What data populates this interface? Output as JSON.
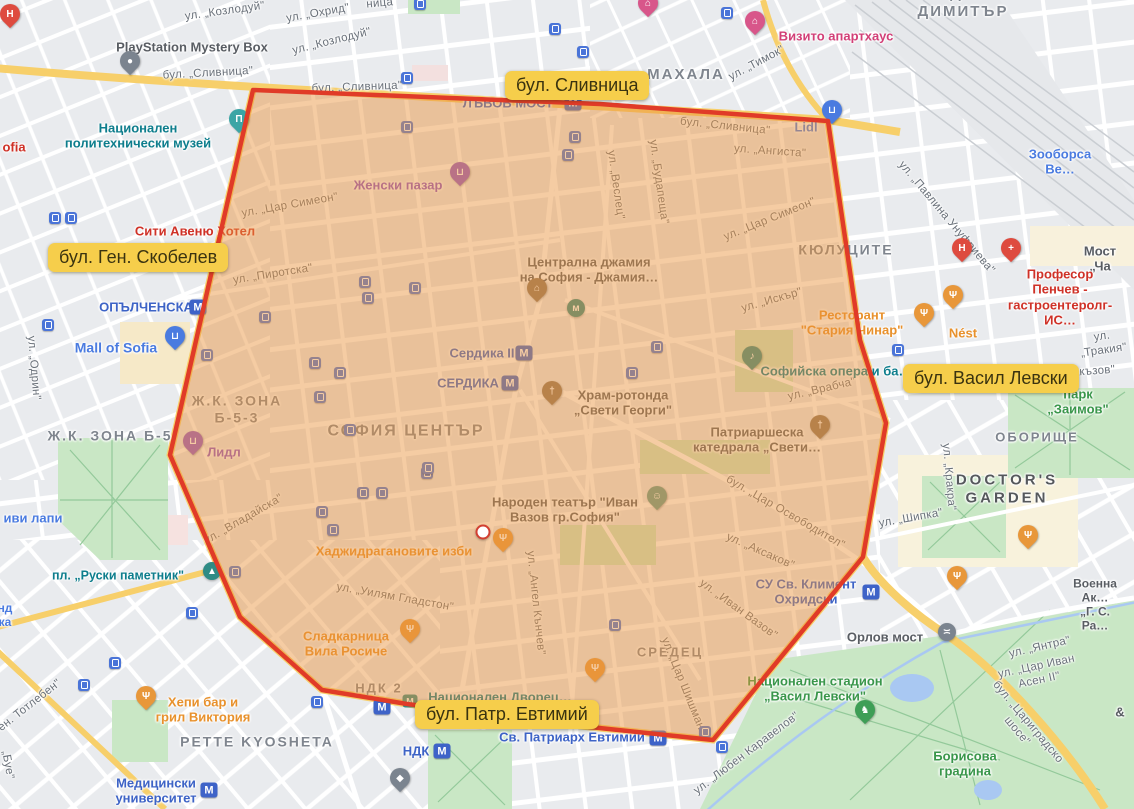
{
  "canvas": {
    "width": 1134,
    "height": 809
  },
  "palette": {
    "map_background": "#e9ebee",
    "road_white": "#ffffff",
    "road_yellow": "#f7cf6a",
    "park_green": "#c9e7c5",
    "water_blue": "#a9c8f2",
    "railway": "#e6e8eb",
    "overlay_fill": "#e9923c",
    "overlay_stroke": "#e03b28",
    "highlight_label_bg": "#f6ce4b",
    "highlight_label_text": "#3a3310",
    "metro_blue": "#3d63c6",
    "transit_blue": "#4a74d8",
    "poi_teal": "#0d7d8c",
    "poi_orange": "#e8912c",
    "poi_red": "#cf3127",
    "poi_green": "#39964a",
    "poi_purple": "#8b53c6",
    "poi_blue": "#4a7be0"
  },
  "region_overlay": {
    "points": "253,90 600,104 828,121 860,340 886,423 863,557 713,740 590,727 407,704 322,690 240,617 170,455",
    "fill": "#e9923c",
    "fill_opacity": 0.47,
    "stroke": "#e03b28",
    "stroke_width": 4.5
  },
  "center_marker": {
    "x": 483,
    "y": 532
  },
  "highlight_labels": [
    {
      "text": "бул. Сливница",
      "left": 505,
      "top": 71
    },
    {
      "text": "бул. Ген. Скобелев",
      "left": 48,
      "top": 243
    },
    {
      "text": "бул. Васил Левски",
      "left": 903,
      "top": 364
    },
    {
      "text": "бул. Патр. Евтимий",
      "left": 415,
      "top": 700
    }
  ],
  "labels": [
    {
      "t": "ХАДЖИ",
      "x": 958,
      "y": -6,
      "c": "area",
      "s": 15
    },
    {
      "t": "ДИМИТЪР",
      "x": 963,
      "y": 12,
      "c": "area",
      "s": 15
    },
    {
      "t": "МАХАЛА",
      "x": 686,
      "y": 75,
      "c": "area",
      "s": 15
    },
    {
      "t": "КЮЛУЦИТЕ",
      "x": 846,
      "y": 250,
      "c": "area",
      "s": 14
    },
    {
      "t": "Ж.К. ЗОНА\nБ-5-3",
      "x": 237,
      "y": 409,
      "c": "area",
      "s": 14
    },
    {
      "t": "Ж.К. ЗОНА Б-5",
      "x": 110,
      "y": 436,
      "c": "area",
      "s": 14
    },
    {
      "t": "СОФИЯ ЦЕНТЪР",
      "x": 406,
      "y": 432,
      "c": "area",
      "s": 16
    },
    {
      "t": "СРЕДЕЦ",
      "x": 670,
      "y": 652,
      "c": "area",
      "s": 13
    },
    {
      "t": "ОБОРИЩЕ",
      "x": 1037,
      "y": 437,
      "c": "area",
      "s": 13
    },
    {
      "t": "PETTE KYOSHETA",
      "x": 257,
      "y": 742,
      "c": "area",
      "s": 14
    },
    {
      "t": "DOCTOR'S\nGARDEN",
      "x": 1007,
      "y": 489,
      "c": "area-dark",
      "s": 15
    },
    {
      "t": "НДК 2",
      "x": 379,
      "y": 688,
      "c": "area",
      "s": 13
    },
    {
      "t": "ул. „Козлодуй\"",
      "x": 225,
      "y": 12,
      "c": "street",
      "r": -8
    },
    {
      "t": "ул. „Охрид\"",
      "x": 318,
      "y": 14,
      "c": "street",
      "r": -10
    },
    {
      "t": "ул. „Козлодуй\"",
      "x": 332,
      "y": 42,
      "c": "street",
      "r": -14
    },
    {
      "t": "ница\"",
      "x": 382,
      "y": 4,
      "c": "street",
      "r": -5
    },
    {
      "t": "бул. „Сливница\"",
      "x": 208,
      "y": 74,
      "c": "street",
      "r": -3
    },
    {
      "t": "бул. „Сливница\"",
      "x": 357,
      "y": 88,
      "c": "street",
      "r": -2
    },
    {
      "t": "бул. „Сливница\"",
      "x": 725,
      "y": 127,
      "c": "street",
      "r": 6
    },
    {
      "t": "ул. „Ангиста\"",
      "x": 770,
      "y": 152,
      "c": "street",
      "r": 4
    },
    {
      "t": "ул. „Тимок\"",
      "x": 757,
      "y": 64,
      "c": "street",
      "r": -28
    },
    {
      "t": "ул. „Павлина Унуфриева\"",
      "x": 946,
      "y": 218,
      "c": "street",
      "r": 50
    },
    {
      "t": "ул. „Веслец\"",
      "x": 615,
      "y": 185,
      "c": "street",
      "r": 82
    },
    {
      "t": "ул. „Будапеща\"",
      "x": 658,
      "y": 182,
      "c": "street",
      "r": 82
    },
    {
      "t": "ул. „Цар Симеон\"",
      "x": 290,
      "y": 206,
      "c": "street",
      "r": -10
    },
    {
      "t": "ул. „Цар Симеон\"",
      "x": 770,
      "y": 220,
      "c": "street",
      "r": -22
    },
    {
      "t": "ул. „Пиротска\"",
      "x": 273,
      "y": 275,
      "c": "street",
      "r": -9
    },
    {
      "t": "ул. „Искър\"",
      "x": 772,
      "y": 301,
      "c": "street",
      "r": -16
    },
    {
      "t": "ул. „Одрин\"",
      "x": 33,
      "y": 368,
      "c": "street",
      "r": 85
    },
    {
      "t": "ул. „Врабча\"",
      "x": 822,
      "y": 390,
      "c": "street",
      "r": -13
    },
    {
      "t": "ул. „Тракия\"",
      "x": 1103,
      "y": 344,
      "c": "street",
      "r": -8
    },
    {
      "t": "акъзов\"",
      "x": 1094,
      "y": 372,
      "c": "street",
      "r": -4
    },
    {
      "t": "ул. „Кракра\"",
      "x": 948,
      "y": 477,
      "c": "street",
      "r": 85
    },
    {
      "t": "ул. „Шипка\"",
      "x": 911,
      "y": 519,
      "c": "street",
      "r": -10
    },
    {
      "t": "бул. „Цар Освободител\"",
      "x": 785,
      "y": 513,
      "c": "street",
      "r": 30
    },
    {
      "t": "ул. „Аксаков\"",
      "x": 760,
      "y": 552,
      "c": "street",
      "r": 24
    },
    {
      "t": "ул. „Иван Вазов\"",
      "x": 738,
      "y": 610,
      "c": "street",
      "r": 36
    },
    {
      "t": "ул. „Владайска\"",
      "x": 244,
      "y": 520,
      "c": "street",
      "r": -30
    },
    {
      "t": "ул. „Уилям Гладстон\"",
      "x": 395,
      "y": 598,
      "c": "street",
      "r": 10
    },
    {
      "t": "ул. „Ангел Кънчев\"",
      "x": 535,
      "y": 603,
      "c": "street",
      "r": 84
    },
    {
      "t": "ул. „Цар Шишман\"",
      "x": 683,
      "y": 686,
      "c": "street",
      "r": 68
    },
    {
      "t": "ул. „Любен Каравелов\"",
      "x": 747,
      "y": 754,
      "c": "street",
      "r": -37
    },
    {
      "t": "ул. „Янтра\"",
      "x": 1040,
      "y": 648,
      "c": "street",
      "r": -13
    },
    {
      "t": "ул. „Цар Иван Асен II\"",
      "x": 1038,
      "y": 674,
      "c": "street",
      "r": -12
    },
    {
      "t": "бул. „Цариградско шосе\"",
      "x": 1022,
      "y": 727,
      "c": "street",
      "r": 50
    },
    {
      "t": "ен. Тотлебен\"",
      "x": 30,
      "y": 706,
      "c": "street",
      "r": -38
    },
    {
      "t": "„Буе\"",
      "x": 7,
      "y": 765,
      "c": "street",
      "r": 80
    },
    {
      "t": "Мост „Ча",
      "x": 1100,
      "y": 259,
      "c": "poi",
      "s": 13
    },
    {
      "t": "&",
      "x": 1120,
      "y": 712,
      "c": "poi",
      "s": 13
    },
    {
      "t": "PlayStation Mystery Box",
      "x": 192,
      "y": 47,
      "c": "poi",
      "s": 13
    },
    {
      "t": "Централна джамия\nна София - Джамия…",
      "x": 589,
      "y": 270,
      "c": "poi",
      "s": 13
    },
    {
      "t": "Храм-ротонда\n„Свети Георги\"",
      "x": 623,
      "y": 403,
      "c": "poi",
      "s": 13
    },
    {
      "t": "Патриаршеска\nкатедрала „Свети…",
      "x": 757,
      "y": 440,
      "c": "poi",
      "s": 13
    },
    {
      "t": "Народен театър \"Иван\nВазов гр.София\"",
      "x": 565,
      "y": 510,
      "c": "poi",
      "s": 13
    },
    {
      "t": "Орлов мост",
      "x": 885,
      "y": 637,
      "c": "poi",
      "s": 13
    },
    {
      "t": "Военна Ак…\n„Г. С. Ра…",
      "x": 1095,
      "y": 605,
      "c": "poi",
      "s": 12
    },
    {
      "t": "Национален\nполитехнически музей",
      "x": 138,
      "y": 136,
      "c": "teal",
      "s": 13
    },
    {
      "t": "пл. „Руски паметник\"",
      "x": 118,
      "y": 576,
      "c": "teal",
      "s": 12.5
    },
    {
      "t": "Софийска опера и ба…",
      "x": 836,
      "y": 371,
      "c": "teal",
      "s": 13
    },
    {
      "t": "Национален Дворец…",
      "x": 500,
      "y": 697,
      "c": "teal",
      "s": 13
    },
    {
      "t": "Mall of Sofia",
      "x": 116,
      "y": 348,
      "c": "blue",
      "s": 14
    },
    {
      "t": "иви лапи",
      "x": 33,
      "y": 518,
      "c": "blue",
      "s": 13
    },
    {
      "t": "Зооборса Ве…",
      "x": 1060,
      "y": 162,
      "c": "blue",
      "s": 13
    },
    {
      "t": "Lidl",
      "x": 806,
      "y": 127,
      "c": "blue",
      "s": 13
    },
    {
      "t": "нд",
      "x": 5,
      "y": 608,
      "c": "blue",
      "s": 12
    },
    {
      "t": "ка",
      "x": 5,
      "y": 622,
      "c": "blue",
      "s": 12
    },
    {
      "t": "Женски пазар",
      "x": 398,
      "y": 185,
      "c": "purple",
      "s": 13
    },
    {
      "t": "Лидл",
      "x": 224,
      "y": 452,
      "c": "purple",
      "s": 13
    },
    {
      "t": "Сити Авеню Хотел",
      "x": 195,
      "y": 231,
      "c": "red",
      "s": 13
    },
    {
      "t": "Професор Пенчев -\nгастроентеролг- ИС…",
      "x": 1060,
      "y": 297,
      "c": "red",
      "s": 13
    },
    {
      "t": "ofia",
      "x": 14,
      "y": 147,
      "c": "red",
      "s": 13
    },
    {
      "t": "Визито апартхаус",
      "x": 836,
      "y": 36,
      "c": "pink",
      "s": 13
    },
    {
      "t": "Ресторант\n\"Стария Чинар\"",
      "x": 852,
      "y": 323,
      "c": "orange",
      "s": 13
    },
    {
      "t": "Nést",
      "x": 963,
      "y": 333,
      "c": "orange",
      "s": 13
    },
    {
      "t": "Хаджидрагановите изби",
      "x": 394,
      "y": 551,
      "c": "orange",
      "s": 13
    },
    {
      "t": "Сладкарница\nВила Росиче",
      "x": 346,
      "y": 644,
      "c": "orange",
      "s": 13
    },
    {
      "t": "Хепи бар и\nгрил Виктория",
      "x": 203,
      "y": 710,
      "c": "orange",
      "s": 13
    },
    {
      "t": "парк „Заимов\"",
      "x": 1078,
      "y": 402,
      "c": "green",
      "s": 13
    },
    {
      "t": "Национален стадион\n„Васил Левски\"",
      "x": 815,
      "y": 689,
      "c": "green",
      "s": 13
    },
    {
      "t": "Борисова\nградина",
      "x": 965,
      "y": 764,
      "c": "green",
      "s": 13
    },
    {
      "t": "ОПЪЛЧЕНСКА",
      "x": 146,
      "y": 307,
      "c": "metro",
      "s": 13
    },
    {
      "t": "Сердика II",
      "x": 482,
      "y": 353,
      "c": "metro",
      "s": 13
    },
    {
      "t": "СЕРДИКА",
      "x": 468,
      "y": 383,
      "c": "metro",
      "s": 13
    },
    {
      "t": "ЛЪВОВ МОСТ",
      "x": 508,
      "y": 103,
      "c": "metro",
      "s": 13
    },
    {
      "t": "СУ Св. Климент\nОхридски",
      "x": 806,
      "y": 592,
      "c": "metro",
      "s": 13
    },
    {
      "t": "Св. Патриарх Евтимий",
      "x": 572,
      "y": 737,
      "c": "metro",
      "s": 13
    },
    {
      "t": "НДК",
      "x": 416,
      "y": 751,
      "c": "metro",
      "s": 13
    },
    {
      "t": "Медицински\nуниверситет",
      "x": 156,
      "y": 791,
      "c": "metro",
      "s": 13
    }
  ],
  "pins": [
    {
      "x": 10,
      "y": 25,
      "color": "#de4b3f",
      "glyph": "H",
      "shape": "pin",
      "name": "hospital-pin"
    },
    {
      "x": 130,
      "y": 72,
      "color": "#7b848f",
      "glyph": "●",
      "shape": "pin",
      "name": "playstation-pin"
    },
    {
      "x": 239,
      "y": 130,
      "color": "#3ba5a5",
      "glyph": "Π",
      "shape": "pin",
      "name": "museum-pin"
    },
    {
      "x": 460,
      "y": 183,
      "color": "#8f55c9",
      "glyph": "⊔",
      "shape": "pin",
      "name": "market-cart-pin"
    },
    {
      "x": 537,
      "y": 299,
      "color": "#8d7358",
      "glyph": "⌂",
      "shape": "pin",
      "name": "mosque-pin"
    },
    {
      "x": 576,
      "y": 308,
      "color": "#2f8b85",
      "glyph": "м",
      "shape": "dot",
      "name": "baths-dot"
    },
    {
      "x": 552,
      "y": 402,
      "color": "#8d7358",
      "glyph": "†",
      "shape": "pin",
      "name": "rotunda-church-pin"
    },
    {
      "x": 820,
      "y": 436,
      "color": "#8d7358",
      "glyph": "†",
      "shape": "pin",
      "name": "cathedral-pin"
    },
    {
      "x": 752,
      "y": 367,
      "color": "#2f8b85",
      "glyph": "♪",
      "shape": "pin",
      "name": "opera-pin"
    },
    {
      "x": 212,
      "y": 571,
      "color": "#2f8b85",
      "glyph": "▲",
      "shape": "dot",
      "name": "monument-dot"
    },
    {
      "x": 175,
      "y": 347,
      "color": "#4a7be0",
      "glyph": "⊔",
      "shape": "pin",
      "name": "mall-pin"
    },
    {
      "x": 193,
      "y": 452,
      "color": "#8f55c9",
      "glyph": "⊔",
      "shape": "pin",
      "name": "lidl-bg-pin"
    },
    {
      "x": 832,
      "y": 121,
      "color": "#4a7be0",
      "glyph": "⊔",
      "shape": "pin",
      "name": "lidl-pin"
    },
    {
      "x": 924,
      "y": 324,
      "color": "#e8973a",
      "glyph": "Ψ",
      "shape": "pin",
      "name": "restaurant-pin"
    },
    {
      "x": 953,
      "y": 306,
      "color": "#e8973a",
      "glyph": "Ψ",
      "shape": "pin",
      "name": "restaurant-pin"
    },
    {
      "x": 962,
      "y": 259,
      "color": "#de4b3f",
      "glyph": "H",
      "shape": "pin",
      "name": "hospital-pin"
    },
    {
      "x": 1011,
      "y": 259,
      "color": "#de4b3f",
      "glyph": "+",
      "shape": "pin",
      "name": "clinic-pin"
    },
    {
      "x": 648,
      "y": 14,
      "color": "#d8568a",
      "glyph": "⌂",
      "shape": "pin",
      "name": "hotel-pin"
    },
    {
      "x": 755,
      "y": 32,
      "color": "#d8568a",
      "glyph": "⌂",
      "shape": "pin",
      "name": "hotel-pin"
    },
    {
      "x": 503,
      "y": 549,
      "color": "#e8973a",
      "glyph": "Ψ",
      "shape": "pin",
      "name": "restaurant-pin"
    },
    {
      "x": 657,
      "y": 507,
      "color": "#5f9c8f",
      "glyph": "☺",
      "shape": "pin",
      "name": "theatre-pin"
    },
    {
      "x": 410,
      "y": 640,
      "color": "#e8973a",
      "glyph": "Ψ",
      "shape": "pin",
      "name": "restaurant-pin"
    },
    {
      "x": 146,
      "y": 707,
      "color": "#e8973a",
      "glyph": "Ψ",
      "shape": "pin",
      "name": "restaurant-pin"
    },
    {
      "x": 595,
      "y": 679,
      "color": "#e8973a",
      "glyph": "Ψ",
      "shape": "pin",
      "name": "restaurant-pin"
    },
    {
      "x": 1028,
      "y": 546,
      "color": "#e8973a",
      "glyph": "Ψ",
      "shape": "pin",
      "name": "restaurant-pin"
    },
    {
      "x": 957,
      "y": 587,
      "color": "#e8973a",
      "glyph": "Ψ",
      "shape": "pin",
      "name": "restaurant-pin"
    },
    {
      "x": 947,
      "y": 632,
      "color": "#7b848f",
      "glyph": "≍",
      "shape": "dot",
      "name": "bridge-dot"
    },
    {
      "x": 400,
      "y": 789,
      "color": "#7b848f",
      "glyph": "◆",
      "shape": "pin",
      "name": "university-pin"
    },
    {
      "x": 865,
      "y": 721,
      "color": "#3e9e56",
      "glyph": "♞",
      "shape": "pin",
      "name": "zoo-pin"
    },
    {
      "x": 410,
      "y": 701,
      "color": "#2f8b85",
      "glyph": "М",
      "shape": "sq",
      "name": "culture-palace-icon"
    }
  ],
  "metro_icons": [
    [
      198,
      307
    ],
    [
      524,
      353
    ],
    [
      510,
      383
    ],
    [
      573,
      103
    ],
    [
      871,
      592
    ],
    [
      658,
      738
    ],
    [
      442,
      751
    ],
    [
      382,
      707
    ],
    [
      209,
      790
    ]
  ],
  "transit_stops": [
    [
      420,
      4
    ],
    [
      555,
      29
    ],
    [
      583,
      52
    ],
    [
      407,
      78
    ],
    [
      727,
      13
    ],
    [
      55,
      218
    ],
    [
      71,
      218
    ],
    [
      48,
      325
    ],
    [
      898,
      350
    ],
    [
      115,
      663
    ],
    [
      84,
      685
    ],
    [
      192,
      613
    ],
    [
      317,
      702
    ],
    [
      722,
      747
    ],
    [
      705,
      732
    ],
    [
      407,
      127
    ],
    [
      575,
      137
    ],
    [
      568,
      155
    ],
    [
      365,
      282
    ],
    [
      368,
      298
    ],
    [
      415,
      288
    ],
    [
      315,
      363
    ],
    [
      340,
      373
    ],
    [
      320,
      397
    ],
    [
      350,
      430
    ],
    [
      657,
      347
    ],
    [
      632,
      373
    ],
    [
      427,
      473
    ],
    [
      363,
      493
    ],
    [
      382,
      493
    ],
    [
      322,
      512
    ],
    [
      333,
      530
    ],
    [
      615,
      625
    ],
    [
      265,
      317
    ],
    [
      207,
      355
    ],
    [
      235,
      572
    ],
    [
      428,
      468
    ]
  ]
}
